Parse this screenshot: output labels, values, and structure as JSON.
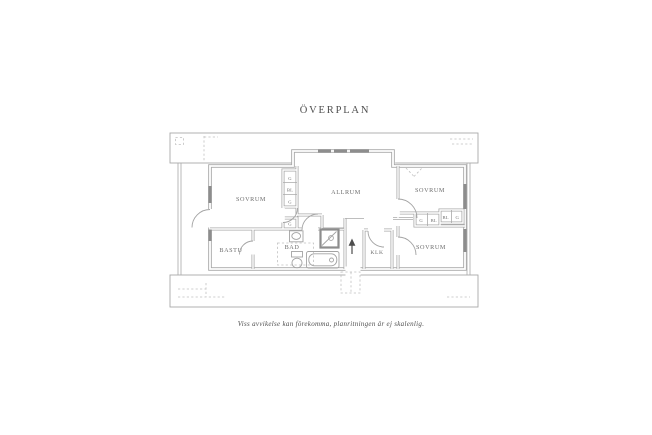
{
  "page": {
    "title": "ÖVERPLAN",
    "caption": "Viss avvikelse kan förekomma, planritningen är ej skalenlig."
  },
  "rooms": {
    "sovrum_left": "SOVRUM",
    "allrum": "ALLRUM",
    "sovrum_top_right": "SOVRUM",
    "sovrum_bottom_right": "SOVRUM",
    "bastu": "BASTU",
    "bad": "BAD",
    "klk": "KLK"
  },
  "closets": {
    "left_column": [
      "G",
      "BL",
      "G"
    ],
    "hall": "G",
    "right_row": [
      "G",
      "BL",
      "BL",
      "G"
    ]
  },
  "colors": {
    "wall": "#a9a9a9",
    "window": "#8d8d8d",
    "label": "#6f6f6f",
    "dashed": "#c0c0c0",
    "arrow": "#4d4d4d",
    "title": "#4f4f4f",
    "caption": "#4f4f4f"
  }
}
